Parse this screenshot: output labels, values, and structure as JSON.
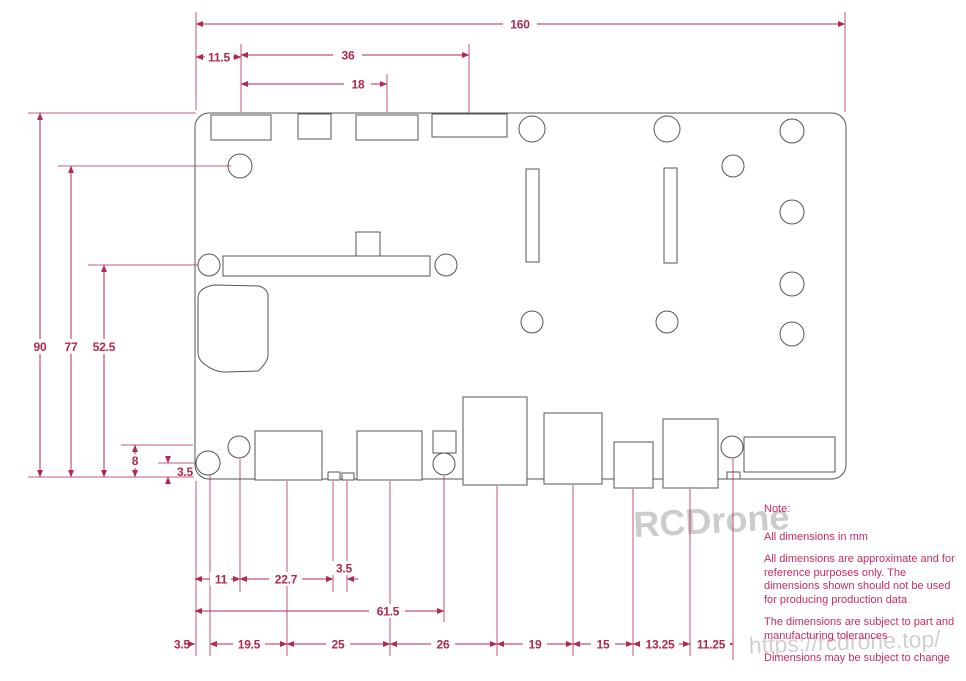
{
  "drawing": {
    "type": "pcb-dimension-drawing",
    "units": "mm",
    "board": {
      "width_mm": "160",
      "height_mm": "90"
    }
  },
  "dims": {
    "d160": "160",
    "d11_5": "11.5",
    "d36": "36",
    "d18": "18",
    "d90": "90",
    "d77": "77",
    "d52_5": "52.5",
    "d8": "8",
    "dl3_5": "3.5",
    "db11": "11",
    "db22_7": "22.7",
    "db3_5a": "3.5",
    "db61_5": "61.5",
    "db3_5b": "3.5",
    "db19_5": "19.5",
    "db25": "25",
    "db26": "26",
    "db19": "19",
    "db15": "15",
    "db13_25": "13.25",
    "db11_25": "11.25"
  },
  "notes": {
    "heading": "Note:",
    "line1": "All dimensions in mm",
    "line2": "All dimensions are approximate and for reference purposes only. The dimensions shown should not be used for producing production data",
    "line3": "The dimensions are subject to part and manufacturing tolerances",
    "line4": "Dimensions may be subject to change"
  },
  "watermark": {
    "brand": "RCDrone",
    "url": "https://rcdrone.top/"
  },
  "colors": {
    "dimension_line": "#b22a50",
    "dimension_text": "#b0294d",
    "notes_text": "#c62d5c",
    "outline": "#555555",
    "watermark": "#c7c7c7",
    "background": "#ffffff"
  }
}
